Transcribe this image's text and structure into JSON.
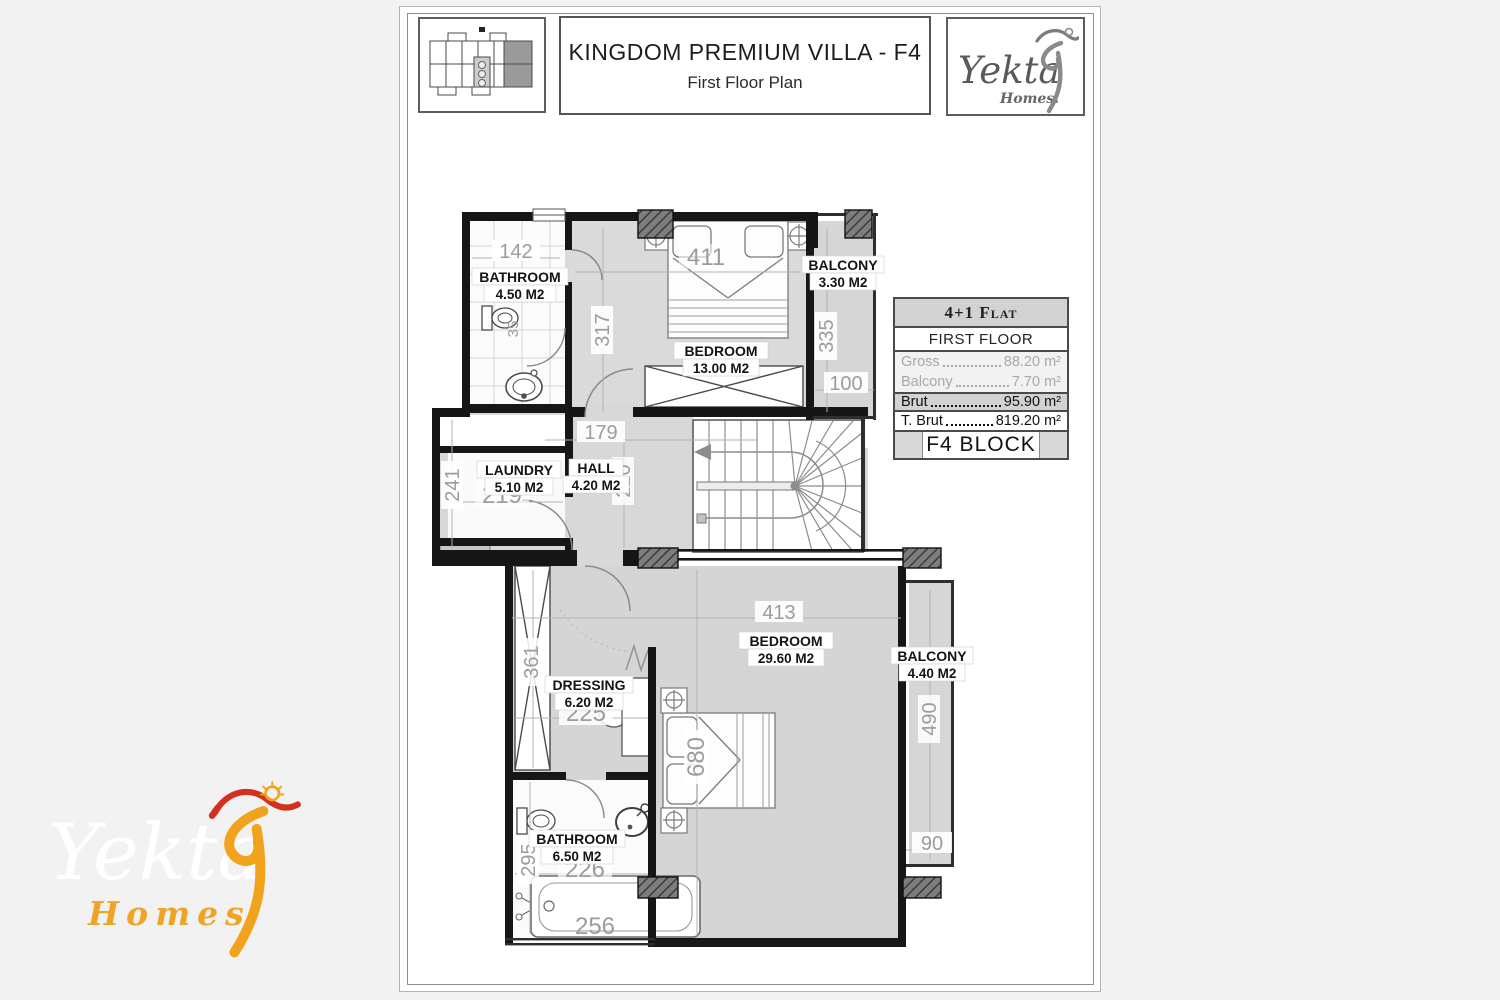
{
  "header": {
    "title": "KINGDOM PREMIUM VILLA - F4",
    "subtitle": "First Floor Plan",
    "logo_brand": "Yekta",
    "logo_sub": "Homes."
  },
  "info_table": {
    "flat_type": "4+1 Flat",
    "floor": "FIRST FLOOR",
    "rows": [
      {
        "label": "Gross",
        "value": "88.20 m²"
      },
      {
        "label": "Balcony",
        "value": "7.70 m²"
      },
      {
        "label": "Brut",
        "value": "95.90 m²"
      },
      {
        "label": "T. Brut",
        "value": "819.20 m²"
      }
    ],
    "block": "F4 BLOCK"
  },
  "plan": {
    "rooms": [
      {
        "name": "BATHROOM",
        "area": "4.50 M2"
      },
      {
        "name": "BEDROOM",
        "area": "13.00 M2"
      },
      {
        "name": "BALCONY",
        "area": "3.30 M2"
      },
      {
        "name": "LAUNDRY",
        "area": "5.10 M2"
      },
      {
        "name": "HALL",
        "area": "4.20 M2"
      },
      {
        "name": "DRESSING",
        "area": "6.20 M2"
      },
      {
        "name": "BEDROOM",
        "area": "29.60 M2"
      },
      {
        "name": "BALCONY",
        "area": "4.40 M2"
      },
      {
        "name": "BATHROOM",
        "area": "6.50 M2"
      }
    ],
    "dims": {
      "d142": "142",
      "d411": "411",
      "d317": "317",
      "d335": "335",
      "d100": "100",
      "d179": "179",
      "d220": "220",
      "d241": "241",
      "d219": "219",
      "d35": "35",
      "d413": "413",
      "d361": "361",
      "d225": "225",
      "d680": "680",
      "d490": "490",
      "d90": "90",
      "d295": "295",
      "d226": "226",
      "d256": "256"
    }
  },
  "watermark": {
    "brand": "Yekta",
    "sub": "Homes"
  }
}
